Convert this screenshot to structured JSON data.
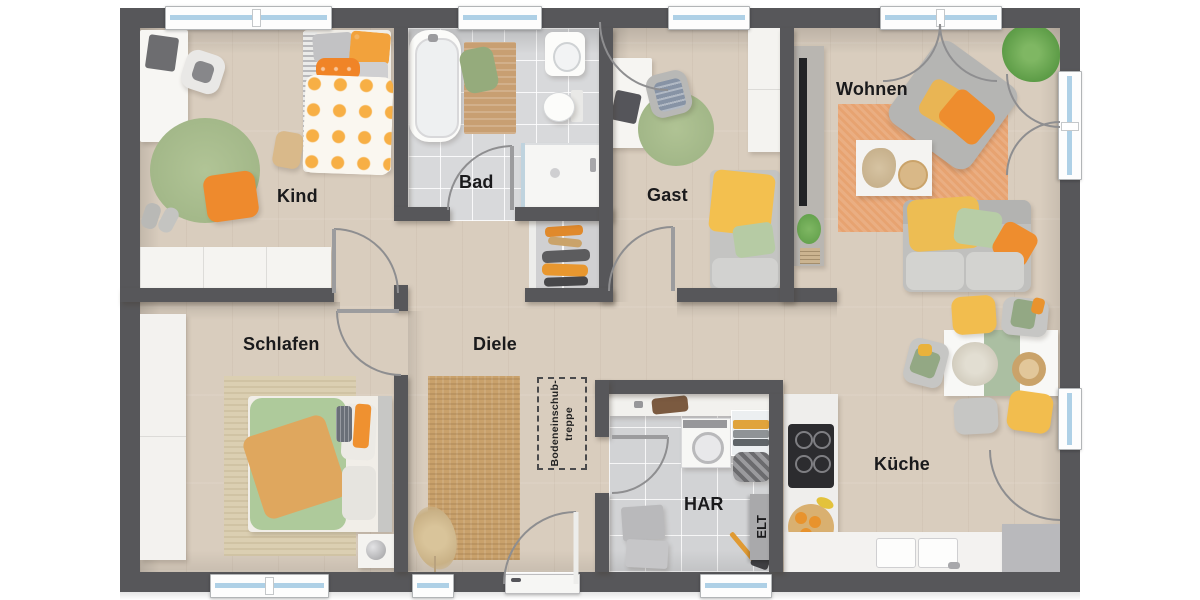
{
  "plan_title": "floor-plan",
  "rooms": [
    {
      "id": "kind",
      "label": "Kind"
    },
    {
      "id": "bad",
      "label": "Bad"
    },
    {
      "id": "gast",
      "label": "Gast"
    },
    {
      "id": "wohnen",
      "label": "Wohnen"
    },
    {
      "id": "schlafen",
      "label": "Schlafen"
    },
    {
      "id": "diele",
      "label": "Diele"
    },
    {
      "id": "har",
      "label": "HAR"
    },
    {
      "id": "kueche",
      "label": "Küche"
    }
  ],
  "annotations": {
    "elt": "ELT",
    "attic_hatch_line1": "Bodeneinschub-",
    "attic_hatch_line2": "treppe"
  },
  "palette": {
    "wall": "#57575a",
    "wood_floor": "#d9cdbe",
    "bath_tile": "#d8d9db",
    "window_glass": "#aed0e6",
    "accent_orange": "#ee8d2e",
    "accent_yellow": "#f2bd4e",
    "accent_green": "#aeca9b",
    "rug_green": "#a9bd8f",
    "rug_jute": "#c9a16b",
    "rug_terracotta": "#e7a371"
  }
}
